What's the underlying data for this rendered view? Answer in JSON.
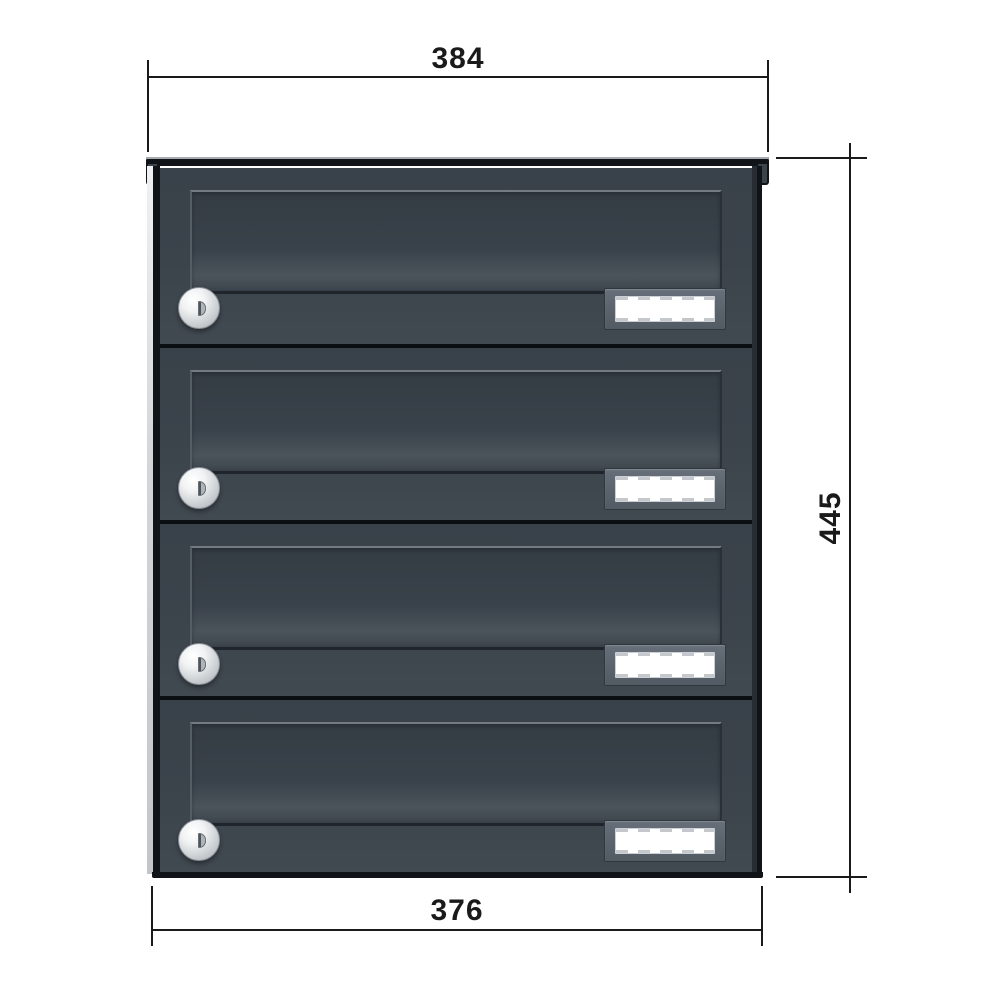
{
  "drawing": {
    "type": "product-dimension-drawing",
    "subject": "4-unit stacked letterbox, front view",
    "dimensions": {
      "top_width": {
        "label": "384"
      },
      "right_height": {
        "label": "445"
      },
      "bottom_width": {
        "label": "376"
      }
    },
    "mailbox": {
      "units": [
        {
          "id": 1,
          "lock": "cylinder-lock",
          "nameplate": "blank"
        },
        {
          "id": 2,
          "lock": "cylinder-lock",
          "nameplate": "blank"
        },
        {
          "id": 3,
          "lock": "cylinder-lock",
          "nameplate": "blank"
        },
        {
          "id": 4,
          "lock": "cylinder-lock",
          "nameplate": "blank"
        }
      ]
    }
  },
  "colors": {
    "page-bg": "#ffffff",
    "dim-color": "#1a1a1a",
    "anthracite": "#3b434b",
    "edge-dark": "#101418",
    "plate-white": "#ffffff"
  }
}
